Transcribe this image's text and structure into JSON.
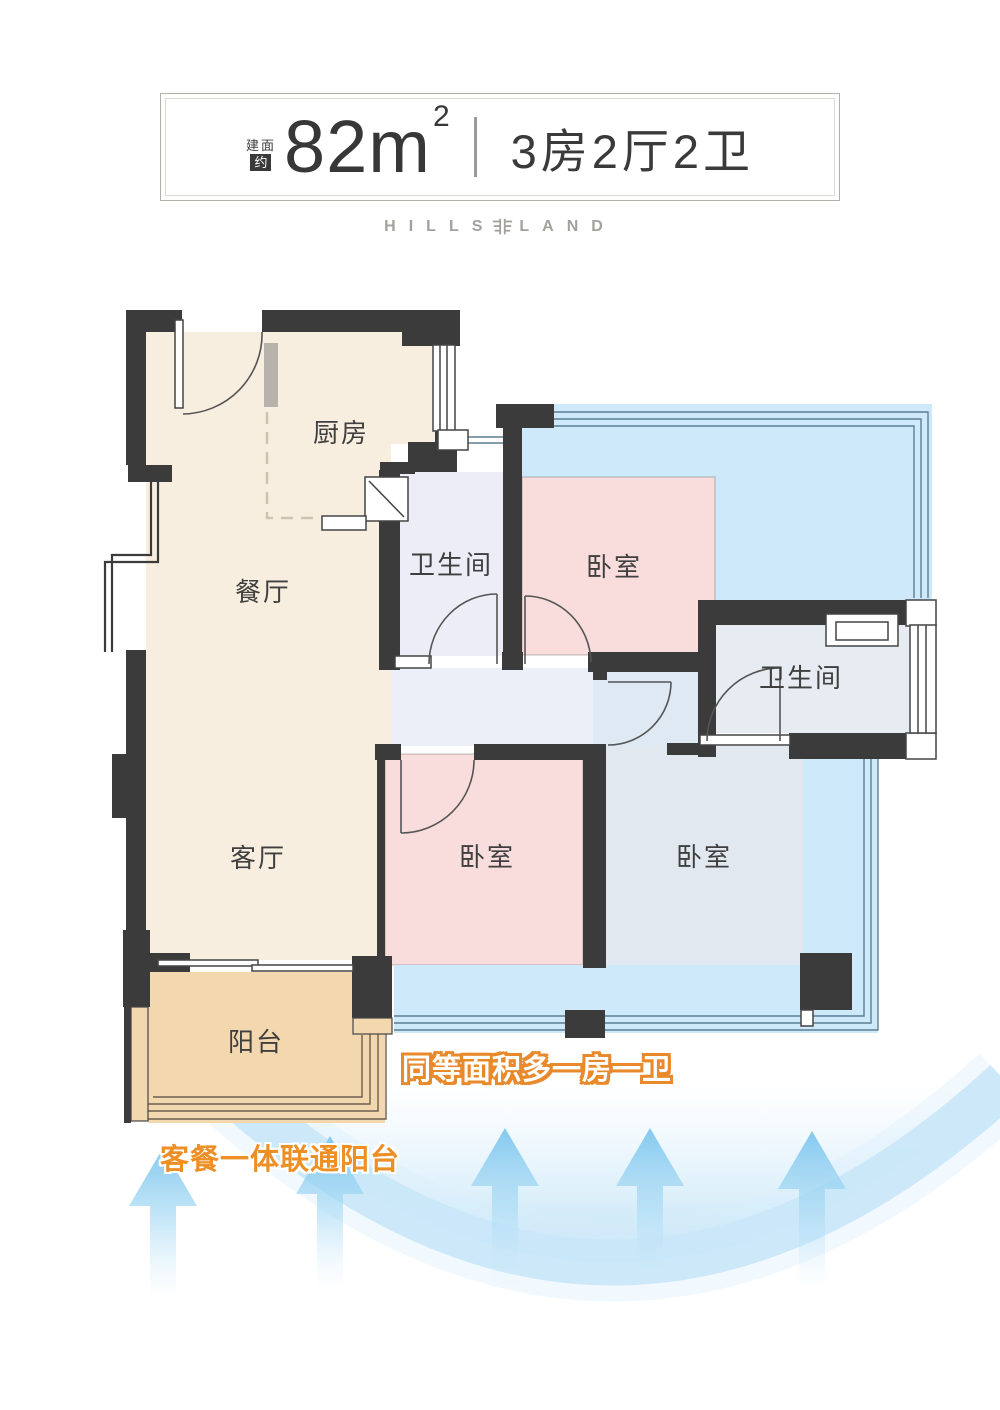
{
  "header": {
    "badge_line1": "建面",
    "badge_line2": "约",
    "area_value": "82",
    "area_unit": "m",
    "area_exponent": "2",
    "spec": "3房2厅2卫",
    "brand_left": "HILLS",
    "brand_right": "LAND"
  },
  "floorplan": {
    "rooms": [
      {
        "id": "kitchen",
        "label": "厨房"
      },
      {
        "id": "dining",
        "label": "餐厅"
      },
      {
        "id": "living",
        "label": "客厅"
      },
      {
        "id": "balcony",
        "label": "阳台"
      },
      {
        "id": "bath-1",
        "label": "卫生间"
      },
      {
        "id": "bedroom-1",
        "label": "卧室"
      },
      {
        "id": "bath-2",
        "label": "卫生间"
      },
      {
        "id": "bedroom-2",
        "label": "卧室"
      },
      {
        "id": "bedroom-3",
        "label": "卧室"
      }
    ],
    "annotations": [
      {
        "id": "note-upgrade",
        "text": "同等面积多一房一卫"
      },
      {
        "id": "note-balcony",
        "text": "客餐一体联通阳台"
      }
    ]
  },
  "colors": {
    "wall": "#3b3b3b",
    "cream": "#f8eee0",
    "balcony_tan": "#f3d7ae",
    "bedroom_pink": "#f9dcdc",
    "bath_lavender": "#ecedf7",
    "alt_overlay_blue": "#cde9fa",
    "accent_orange": "#ee8f25",
    "arrow_blue": "#7ec6ee"
  }
}
